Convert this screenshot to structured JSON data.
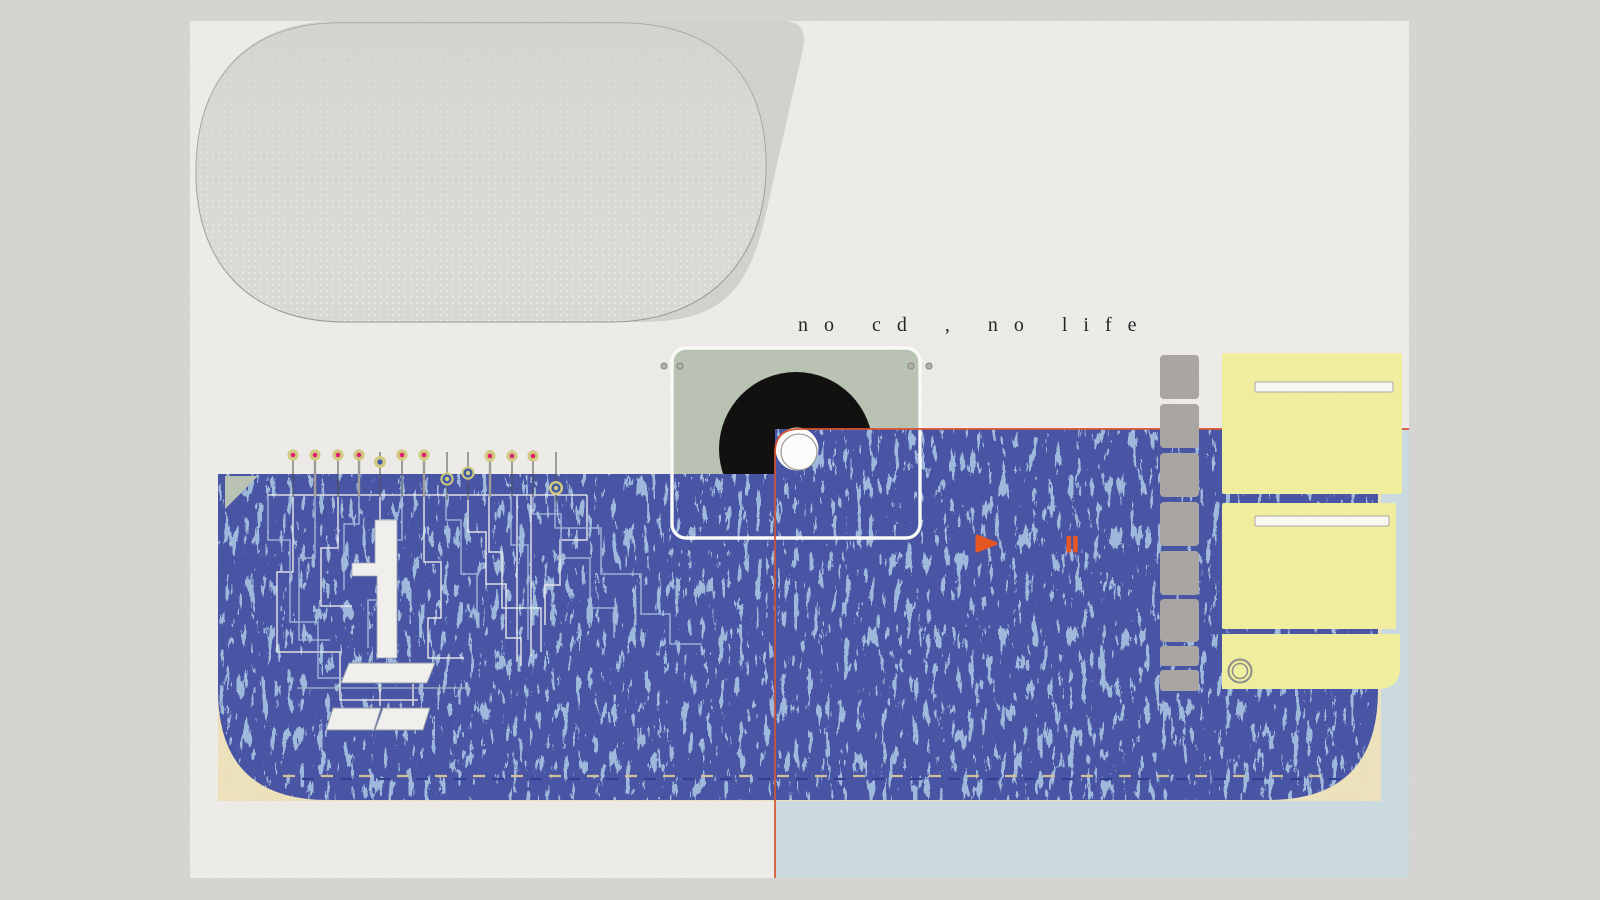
{
  "poster": {
    "title": "no cd , no life",
    "player": {
      "play_icon": "play-triangle-icon",
      "pause_icon": "pause-bars-icon"
    },
    "elements": {
      "pins_count": 13,
      "ladder_segments": 8,
      "drive_panels": 3,
      "drive_slots": 2,
      "corner_screws": 4,
      "halftone_blob": "dotted-capsule",
      "disc": "black-vinyl-disc",
      "hub": "white-hub-circle"
    },
    "palette": {
      "background": "#d6d5d2",
      "canvas": "#efedea",
      "indigo": "#4551a4",
      "speckle_blue": "#9db9dd",
      "light_blue": "#cbdce1",
      "beige": "#eee3bb",
      "sage": "#b9c3b3",
      "yellow": "#f2f09d",
      "gray_segment": "#a8a5a2",
      "orange": "#e8531e",
      "red_line": "#d6502c",
      "khaki": "#d2cb7e",
      "magenta": "#e2186e",
      "pin_blue": "#3b55a8",
      "disc_black": "#0c0b09"
    }
  }
}
